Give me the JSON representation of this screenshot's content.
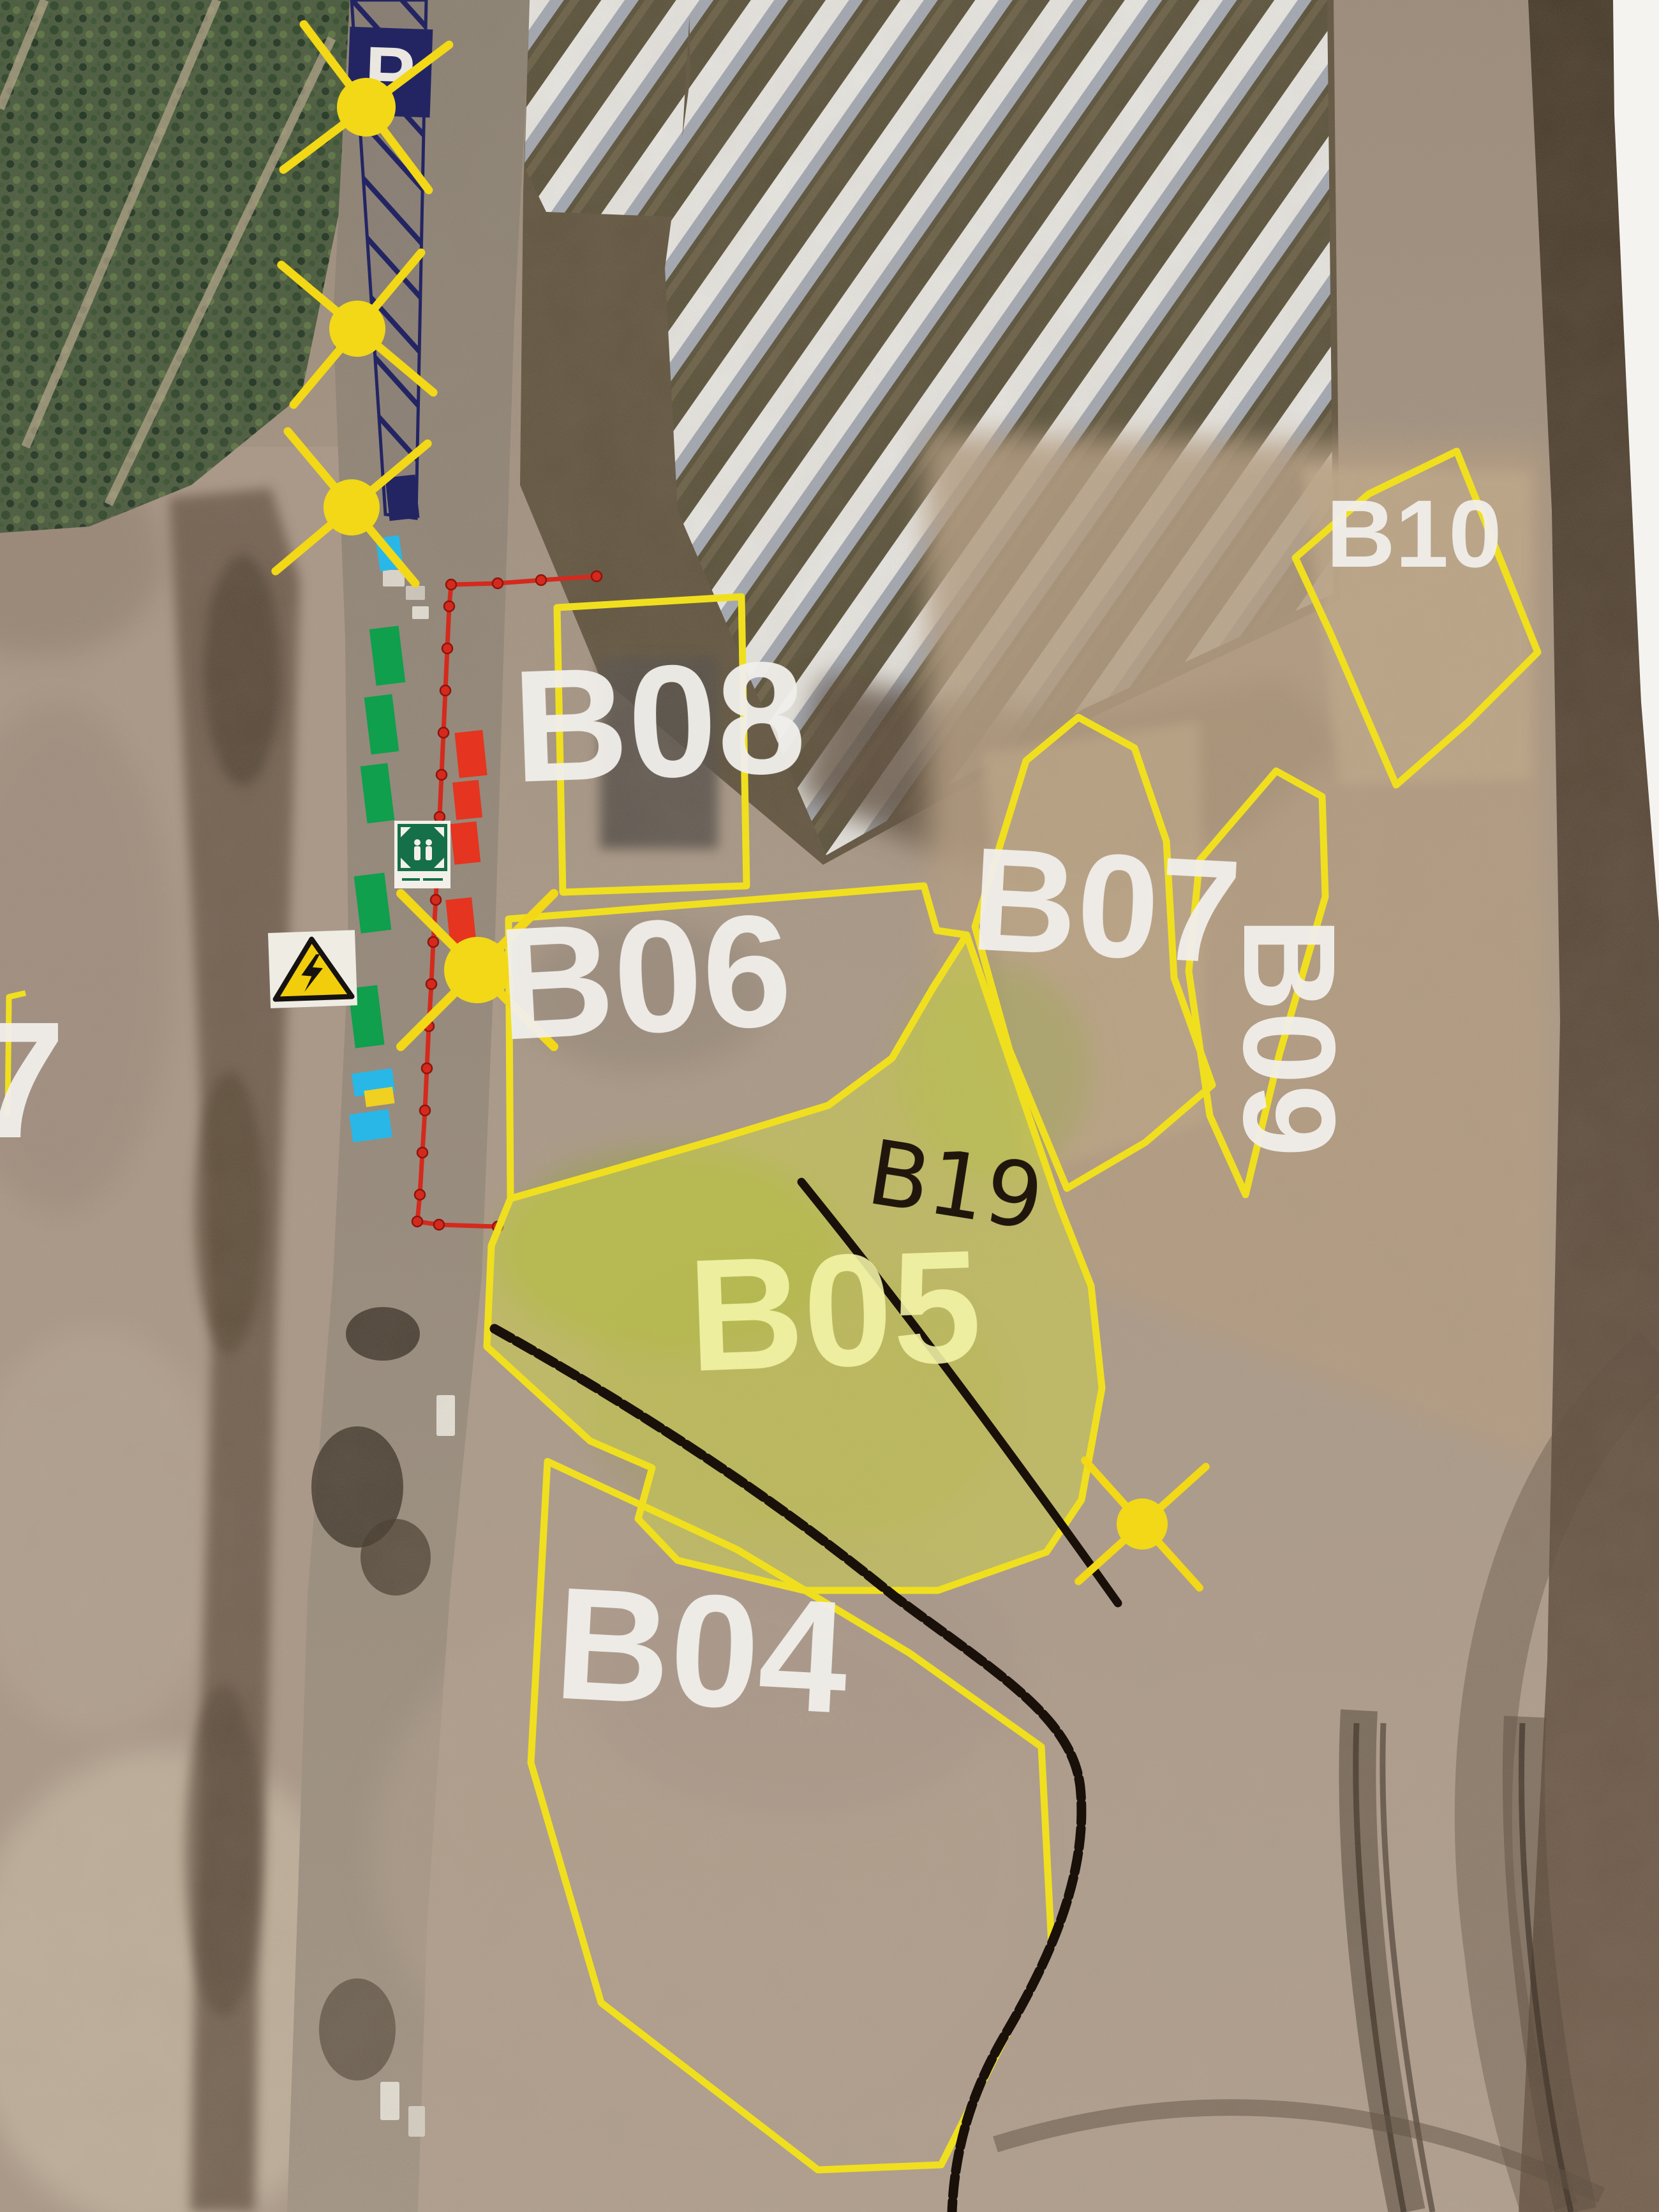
{
  "map": {
    "description": "Aerial construction-site zone plan (photographed printout)",
    "zones": {
      "b04": "B04",
      "b05": "B05",
      "b06": "B06",
      "b07": "B07",
      "b08": "B08",
      "b09": "B09",
      "b10": "B10",
      "partial_left": "7"
    },
    "annotations": {
      "handwritten": "B19"
    },
    "signs": {
      "parking_letter": "P"
    },
    "icons": {
      "light_mast": "light-mast-icon (yellow circle with X rays)",
      "parking": "parking-sign",
      "assembly_point": "assembly-point-sign",
      "high_voltage": "high-voltage-warning-sign",
      "fence": "red dashed fence line with posts"
    },
    "colors": {
      "zone_outline": "#f0df1e",
      "zone_label": "#f1efeb",
      "b05_highlight": "#d6e03c",
      "b05_label": "#f4f4a8",
      "fence_line": "#d42a1e",
      "parking_navy": "#232563",
      "sun_marker": "#f2d816",
      "marker_green": "#0f9f4d",
      "marker_red": "#e5341f",
      "marker_cyan": "#29b7e8",
      "marker_yellow": "#f0d020",
      "assembly_sign_green": "#156f49",
      "warning_sign_yellow": "#f2cd0c",
      "hand_annotation": "#20160c",
      "black_route_line": "#191009"
    }
  }
}
